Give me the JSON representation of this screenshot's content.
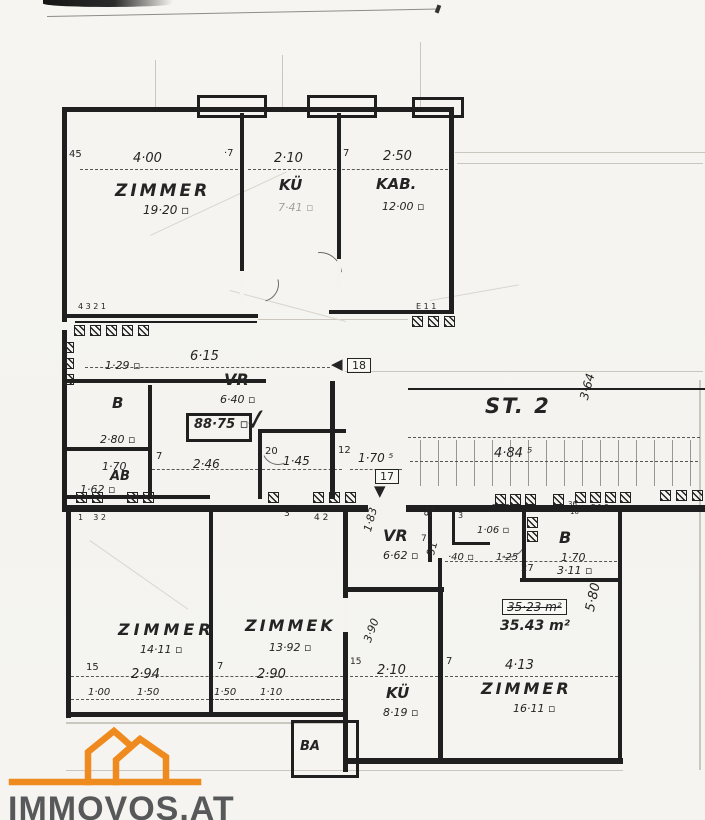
{
  "branding": {
    "logo_text": "IMMOVOS.AT",
    "logo_color": "#ef8a1f",
    "logo_text_color": "#57585a"
  },
  "colors": {
    "ink": "#1f1f1f",
    "paper": "#f4f3ef"
  },
  "plan": {
    "sections": [
      {
        "name": "upper-apartment",
        "labels": [
          {
            "n": "dim-wall-45",
            "t": "45",
            "x": 69,
            "y": 150,
            "fs": 10
          },
          {
            "n": "dim-4-00",
            "t": "4·00",
            "x": 133,
            "y": 152,
            "fs": 13,
            "it": 1
          },
          {
            "n": "dim-wall-7a",
            "t": "·7",
            "x": 224,
            "y": 149,
            "fs": 10
          },
          {
            "n": "dim-2-10",
            "t": "2·10",
            "x": 274,
            "y": 152,
            "fs": 13,
            "it": 1
          },
          {
            "n": "dim-wall-7b",
            "t": "7",
            "x": 343,
            "y": 149,
            "fs": 10
          },
          {
            "n": "dim-2-50",
            "t": "2·50",
            "x": 383,
            "y": 150,
            "fs": 13,
            "it": 1
          },
          {
            "n": "room-label-zimmer-top",
            "t": "ZIMMER",
            "x": 115,
            "y": 183,
            "fs": 17,
            "it": 1,
            "b": 1,
            "ls": 3
          },
          {
            "n": "area-19-20",
            "t": "19·20 ▫",
            "x": 143,
            "y": 204,
            "fs": 12,
            "it": 1
          },
          {
            "n": "room-label-kue-top",
            "t": "KÜ",
            "x": 279,
            "y": 178,
            "fs": 15,
            "it": 1,
            "b": 1
          },
          {
            "n": "area-7-41",
            "t": "7·41 ▫",
            "x": 278,
            "y": 202,
            "fs": 11,
            "it": 1,
            "faint": 1
          },
          {
            "n": "room-label-kab",
            "t": "KAB.",
            "x": 376,
            "y": 177,
            "fs": 15,
            "it": 1,
            "b": 1
          },
          {
            "n": "area-12-00",
            "t": "12·00 ▫",
            "x": 382,
            "y": 201,
            "fs": 11,
            "it": 1
          },
          {
            "n": "note-4321",
            "t": "4 3 2 1",
            "x": 78,
            "y": 303,
            "fs": 8
          },
          {
            "n": "note-e11",
            "t": "E 1 1",
            "x": 416,
            "y": 303,
            "fs": 8
          }
        ]
      },
      {
        "name": "middle-wing",
        "labels": [
          {
            "n": "dim-6-15",
            "t": "6·15",
            "x": 190,
            "y": 350,
            "fs": 13,
            "it": 1
          },
          {
            "n": "area-1-29",
            "t": "1·29 ▫",
            "x": 105,
            "y": 360,
            "fs": 11,
            "it": 1
          },
          {
            "n": "room-label-vr-top",
            "t": "VR",
            "x": 224,
            "y": 372,
            "fs": 16,
            "it": 1,
            "b": 1
          },
          {
            "n": "area-6-40",
            "t": "6·40 ▫",
            "x": 220,
            "y": 394,
            "fs": 11,
            "it": 1
          },
          {
            "n": "total-area-88-75",
            "t": "88·75 ▫",
            "x": 194,
            "y": 418,
            "fs": 13,
            "it": 1,
            "b": 1
          },
          {
            "n": "check-mark",
            "t": "✓",
            "x": 242,
            "y": 408,
            "fs": 30,
            "rot": -8
          },
          {
            "n": "room-label-b-top",
            "t": "B",
            "x": 112,
            "y": 396,
            "fs": 15,
            "it": 1,
            "b": 1
          },
          {
            "n": "area-2-80",
            "t": "2·80 ▫",
            "x": 100,
            "y": 434,
            "fs": 11,
            "it": 1
          },
          {
            "n": "dim-1-70a",
            "t": "1·70",
            "x": 102,
            "y": 461,
            "fs": 11,
            "it": 1
          },
          {
            "n": "room-label-ab",
            "t": "AB",
            "x": 110,
            "y": 470,
            "fs": 13,
            "it": 1,
            "b": 1
          },
          {
            "n": "area-1-62",
            "t": "1·62 ▫",
            "x": 80,
            "y": 484,
            "fs": 11,
            "it": 1
          },
          {
            "n": "dim-wall-7c",
            "t": "7",
            "x": 156,
            "y": 452,
            "fs": 10
          },
          {
            "n": "dim-2-46",
            "t": "2·46",
            "x": 193,
            "y": 458,
            "fs": 12,
            "it": 1
          },
          {
            "n": "dim-20",
            "t": "20",
            "x": 265,
            "y": 447,
            "fs": 10
          },
          {
            "n": "dim-1-45",
            "t": "1·45",
            "x": 283,
            "y": 455,
            "fs": 12,
            "it": 1
          },
          {
            "n": "dim-12",
            "t": "12",
            "x": 338,
            "y": 446,
            "fs": 10
          },
          {
            "n": "dim-1-70-5",
            "t": "1·70 ⁵",
            "x": 358,
            "y": 452,
            "fs": 12,
            "it": 1
          },
          {
            "n": "door-marker-18",
            "t": "18",
            "x": 347,
            "y": 358,
            "fs": 11,
            "box": 1
          },
          {
            "n": "arrow-left-icon",
            "t": "◀",
            "x": 331,
            "y": 357,
            "fs": 15
          },
          {
            "n": "door-marker-17",
            "t": "17",
            "x": 375,
            "y": 469,
            "fs": 11,
            "box": 1
          },
          {
            "n": "arrow-down-icon",
            "t": "▼",
            "x": 374,
            "y": 484,
            "fs": 15
          }
        ]
      },
      {
        "name": "stairwell",
        "labels": [
          {
            "n": "stairwell-label",
            "t": "ST. 2",
            "x": 485,
            "y": 396,
            "fs": 21,
            "it": 1,
            "b": 1,
            "ls": 2
          },
          {
            "n": "dim-3-64",
            "t": "3·64",
            "x": 578,
            "y": 398,
            "fs": 12,
            "it": 1,
            "rot": -75
          },
          {
            "n": "dim-4-84-5",
            "t": "4·84 ⁵",
            "x": 494,
            "y": 447,
            "fs": 13,
            "it": 1
          }
        ]
      },
      {
        "name": "lower-apartment",
        "labels": [
          {
            "n": "note-1-32",
            "t": "1    3 2",
            "x": 78,
            "y": 514,
            "fs": 8
          },
          {
            "n": "note-3a",
            "t": "3",
            "x": 284,
            "y": 510,
            "fs": 9
          },
          {
            "n": "note-4-2",
            "t": "4 2",
            "x": 314,
            "y": 514,
            "fs": 9
          },
          {
            "n": "note-3b",
            "t": "3",
            "x": 458,
            "y": 512,
            "fs": 8
          },
          {
            "n": "note-e12a",
            "t": "E 1 2",
            "x": 492,
            "y": 504,
            "fs": 7
          },
          {
            "n": "note-36",
            "t": "36",
            "x": 568,
            "y": 501,
            "fs": 7
          },
          {
            "n": "note-10",
            "t": "10",
            "x": 570,
            "y": 509,
            "fs": 7
          },
          {
            "n": "note-e12b",
            "t": "E 1 2",
            "x": 591,
            "y": 504,
            "fs": 7
          },
          {
            "n": "dim-1-83",
            "t": "1·83",
            "x": 362,
            "y": 530,
            "fs": 11,
            "it": 1,
            "rot": -75
          },
          {
            "n": "room-label-vr-lower",
            "t": "VR",
            "x": 383,
            "y": 528,
            "fs": 16,
            "it": 1,
            "b": 1
          },
          {
            "n": "area-6-62",
            "t": "6·62 ▫",
            "x": 383,
            "y": 550,
            "fs": 11,
            "it": 1
          },
          {
            "n": "dim-wall-7d",
            "t": "7",
            "x": 421,
            "y": 535,
            "fs": 9
          },
          {
            "n": "dim-85",
            "t": "85",
            "x": 424,
            "y": 516,
            "fs": 10,
            "rot": -75
          },
          {
            "n": "dim-91",
            "t": "91",
            "x": 425,
            "y": 554,
            "fs": 11,
            "rot": -75
          },
          {
            "n": "dim-40",
            "t": "·40 ▫",
            "x": 448,
            "y": 553,
            "fs": 10,
            "it": 1
          },
          {
            "n": "dim-1-06",
            "t": "1·06 ▫",
            "x": 477,
            "y": 526,
            "fs": 10,
            "it": 1
          },
          {
            "n": "dim-1-25",
            "t": "1·25",
            "x": 496,
            "y": 553,
            "fs": 10,
            "it": 1
          },
          {
            "n": "dim-27",
            "t": "27",
            "x": 521,
            "y": 564,
            "fs": 10
          },
          {
            "n": "room-label-b-lower",
            "t": "B",
            "x": 559,
            "y": 530,
            "fs": 16,
            "it": 1,
            "b": 1
          },
          {
            "n": "dim-1-70b",
            "t": "1·70",
            "x": 561,
            "y": 552,
            "fs": 11,
            "it": 1
          },
          {
            "n": "area-3-11",
            "t": "3·11 ▫",
            "x": 557,
            "y": 565,
            "fs": 11,
            "it": 1
          },
          {
            "n": "area-35-23-old",
            "t": "35·23 m²",
            "x": 502,
            "y": 599,
            "fs": 12,
            "it": 1,
            "box": 1,
            "strike": 1
          },
          {
            "n": "area-35-43",
            "t": "35.43 m²",
            "x": 500,
            "y": 619,
            "fs": 14,
            "it": 1,
            "b": 1
          },
          {
            "n": "dim-5-80",
            "t": "5·80",
            "x": 584,
            "y": 610,
            "fs": 13,
            "it": 1,
            "rot": -78
          },
          {
            "n": "room-label-zimmer-lowerleft",
            "t": "ZIMMER",
            "x": 118,
            "y": 622,
            "fs": 16,
            "it": 1,
            "b": 1,
            "ls": 4
          },
          {
            "n": "area-14-11",
            "t": "14·11 ▫",
            "x": 140,
            "y": 644,
            "fs": 11,
            "it": 1
          },
          {
            "n": "dim-wall-15a",
            "t": "15",
            "x": 86,
            "y": 663,
            "fs": 10
          },
          {
            "n": "dim-2-94",
            "t": "2·94",
            "x": 131,
            "y": 668,
            "fs": 13,
            "it": 1
          },
          {
            "n": "dim-1-00",
            "t": "1·00",
            "x": 88,
            "y": 688,
            "fs": 10,
            "it": 1
          },
          {
            "n": "dim-1-50a",
            "t": "1·50",
            "x": 137,
            "y": 688,
            "fs": 10,
            "it": 1
          },
          {
            "n": "dim-wall-7e",
            "t": "7",
            "x": 217,
            "y": 662,
            "fs": 10
          },
          {
            "n": "room-label-zimmek",
            "t": "ZIMMEK",
            "x": 245,
            "y": 618,
            "fs": 16,
            "it": 1,
            "b": 1,
            "ls": 3
          },
          {
            "n": "area-13-92",
            "t": "13·92 ▫",
            "x": 269,
            "y": 642,
            "fs": 11,
            "it": 1
          },
          {
            "n": "dim-2-90",
            "t": "2·90",
            "x": 257,
            "y": 668,
            "fs": 13,
            "it": 1
          },
          {
            "n": "dim-1-50b",
            "t": "1·50",
            "x": 214,
            "y": 688,
            "fs": 10,
            "it": 1
          },
          {
            "n": "dim-1-10",
            "t": "1·10",
            "x": 260,
            "y": 688,
            "fs": 10,
            "it": 1
          },
          {
            "n": "dim-wall-15b",
            "t": "15",
            "x": 350,
            "y": 658,
            "fs": 9
          },
          {
            "n": "dim-3-90",
            "t": "3·90",
            "x": 362,
            "y": 640,
            "fs": 11,
            "it": 1,
            "rot": -70
          },
          {
            "n": "dim-2-10b",
            "t": "2·10",
            "x": 377,
            "y": 664,
            "fs": 13,
            "it": 1
          },
          {
            "n": "room-label-kue-lower",
            "t": "KÜ",
            "x": 386,
            "y": 686,
            "fs": 15,
            "it": 1,
            "b": 1
          },
          {
            "n": "area-8-19",
            "t": "8·19 ▫",
            "x": 383,
            "y": 707,
            "fs": 11,
            "it": 1
          },
          {
            "n": "dim-wall-7f",
            "t": "7",
            "x": 446,
            "y": 657,
            "fs": 10
          },
          {
            "n": "dim-4-13",
            "t": "4·13",
            "x": 505,
            "y": 659,
            "fs": 13,
            "it": 1
          },
          {
            "n": "room-label-zimmer-lowerright",
            "t": "ZIMMER",
            "x": 481,
            "y": 681,
            "fs": 16,
            "it": 1,
            "b": 1,
            "ls": 3
          },
          {
            "n": "area-16-11",
            "t": "16·11 ▫",
            "x": 513,
            "y": 703,
            "fs": 11,
            "it": 1
          },
          {
            "n": "room-label-ba",
            "t": "BA",
            "x": 300,
            "y": 740,
            "fs": 13,
            "it": 1,
            "b": 1
          }
        ]
      }
    ]
  }
}
